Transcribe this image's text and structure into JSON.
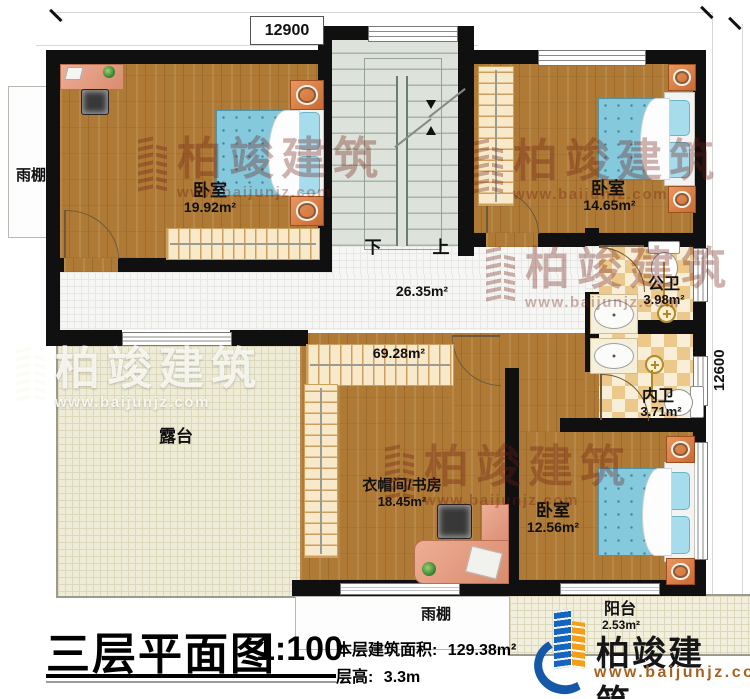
{
  "dimensions": {
    "top": "12900",
    "right": "12600"
  },
  "stairs": {
    "down": "下",
    "up": "上"
  },
  "areas": {
    "corridor": "26.35m²",
    "wardrobe": "69.28m²"
  },
  "rooms": {
    "bedroom1": {
      "name": "卧室",
      "area": "19.92m²"
    },
    "bedroom2": {
      "name": "卧室",
      "area": "14.65m²"
    },
    "public_bath": {
      "name": "公卫",
      "area": "3.98m²"
    },
    "private_bath": {
      "name": "内卫",
      "area": "3.71m²"
    },
    "cloakroom_study": {
      "name": "衣帽间/书房",
      "area": "18.45m²"
    },
    "bedroom3": {
      "name": "卧室",
      "area": "12.56m²"
    },
    "terrace": {
      "name": "露台"
    },
    "balcony": {
      "name": "阳台",
      "area": "2.53m²"
    },
    "canopy_left": {
      "name": "雨棚"
    },
    "canopy_bottom": {
      "name": "雨棚"
    }
  },
  "watermark": {
    "brand": "柏竣建筑",
    "url": "www.baijunjz.com"
  },
  "logo": {
    "brand": "柏竣建筑、",
    "url": "www.baijunjz.com"
  },
  "title": {
    "main": "三层平面图",
    "scale": "1:100",
    "floor_area_label": "本层建筑面积:",
    "floor_area_value": "129.38m²",
    "floor_height_label": "层高:",
    "floor_height_value": "3.3m"
  },
  "colors": {
    "wall": "#101010",
    "wood": "#ae7a35",
    "bed_blue": "#85c9dd",
    "brand_blue": "#1558a8",
    "brand_orange": "#f59f19",
    "watermark_red": "#6e1e14"
  }
}
